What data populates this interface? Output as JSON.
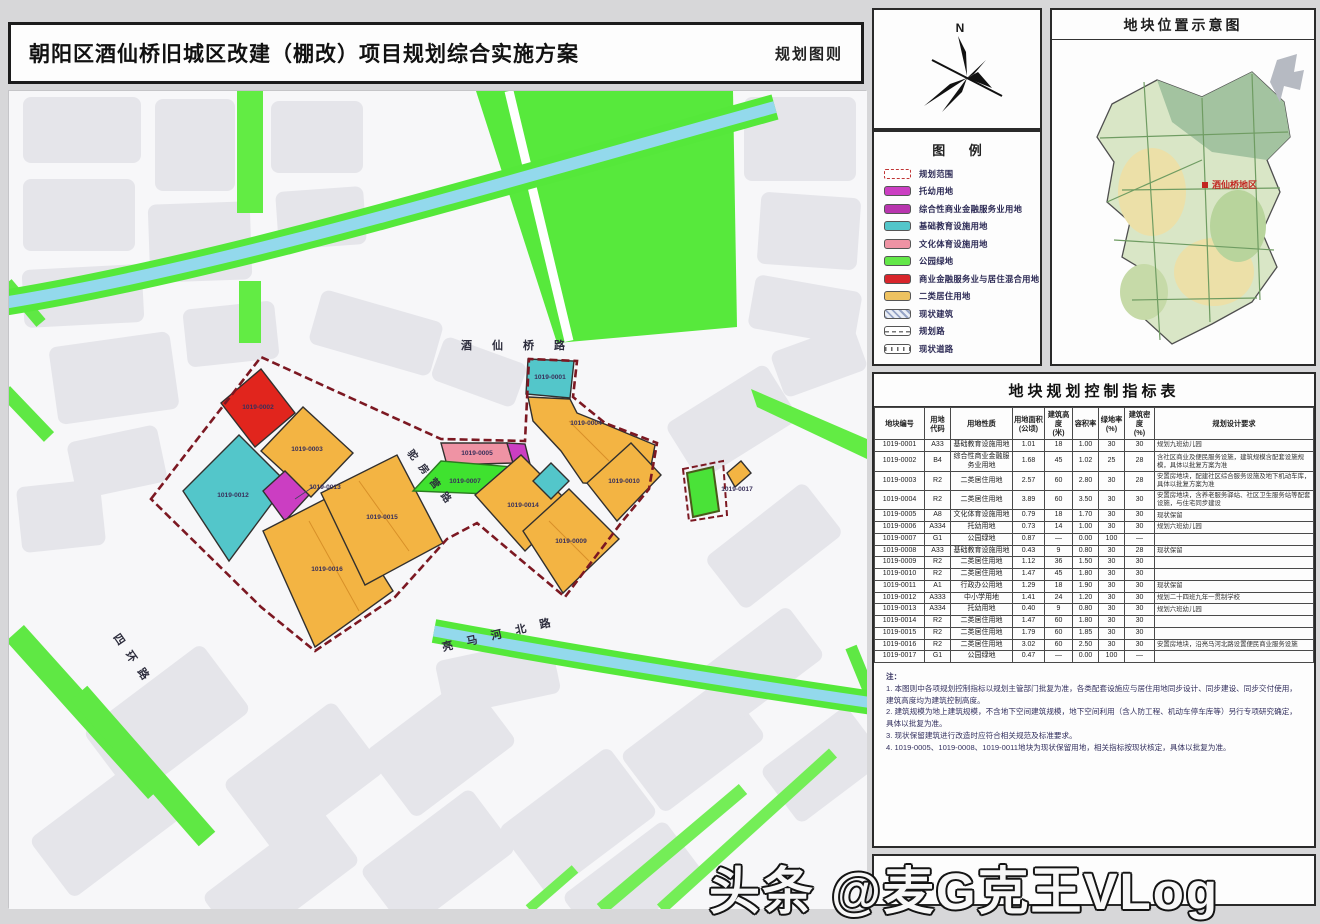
{
  "sheet": {
    "title": "朝阳区酒仙桥旧城区改建（棚改）项目规划综合实施方案",
    "subtitle_right": "规划图则"
  },
  "compass": {
    "label": "N"
  },
  "legend": {
    "title": "图 例",
    "items": [
      {
        "label": "规划范围",
        "swatch": "boundary",
        "color": ""
      },
      {
        "label": "托幼用地",
        "swatch": "fill",
        "color": "#cb3ec2"
      },
      {
        "label": "综合性商业金融服务业用地",
        "swatch": "fill",
        "color": "#b835ae"
      },
      {
        "label": "基础教育设施用地",
        "swatch": "fill",
        "color": "#53c6ca"
      },
      {
        "label": "文化体育设施用地",
        "swatch": "fill",
        "color": "#ef93a4"
      },
      {
        "label": "公园绿地",
        "swatch": "fill",
        "color": "#63e748"
      },
      {
        "label": "商业金融服务业与居住混合用地",
        "swatch": "fill",
        "color": "#d8252b"
      },
      {
        "label": "二类居住用地",
        "swatch": "fill",
        "color": "#eec261"
      },
      {
        "label": "现状建筑",
        "swatch": "hatch",
        "color": ""
      },
      {
        "label": "规划路",
        "swatch": "road-planned",
        "color": ""
      },
      {
        "label": "现状道路",
        "swatch": "road-existing",
        "color": ""
      }
    ]
  },
  "location_map": {
    "title": "地块位置示意图",
    "marker_label": "酒仙桥地区"
  },
  "map": {
    "road_labels": [
      "酒仙桥路",
      "驼房营路",
      "亮马河北路",
      "四环路"
    ],
    "parcel_labels": [
      "1019-0002",
      "1019-0003",
      "1019-0012",
      "1019-0013",
      "1019-0016",
      "1019-0015",
      "1019-0001",
      "1019-0004",
      "1019-0005",
      "1019-0007",
      "1019-0014",
      "1019-0010",
      "1019-0009",
      "1019-0017"
    ]
  },
  "table": {
    "title": "地块规划控制指标表",
    "columns": [
      "地块编号",
      "用地\n代码",
      "用地性质",
      "用地面积\n(公顷)",
      "建筑高度\n(米)",
      "容积率",
      "绿地率\n(%)",
      "建筑密度\n(%)",
      "规划设计要求"
    ],
    "rows": [
      [
        "1019-0001",
        "A33",
        "基础教育设施用地",
        "1.01",
        "18",
        "1.00",
        "30",
        "30",
        "规划九班幼儿园"
      ],
      [
        "1019-0002",
        "B4",
        "综合性商业金融服务业用地",
        "1.68",
        "45",
        "1.02",
        "25",
        "28",
        "含社区商业及便民服务设施，建筑规模含配套设施规模，具体以批复方案为准"
      ],
      [
        "1019-0003",
        "R2",
        "二类居住用地",
        "2.57",
        "60",
        "2.80",
        "30",
        "28",
        "安置房地块，配建社区综合服务设施及地下机动车库，具体以批复方案为准"
      ],
      [
        "1019-0004",
        "R2",
        "二类居住用地",
        "3.89",
        "60",
        "3.50",
        "30",
        "30",
        "安置房地块，含养老服务驿站、社区卫生服务站等配套设施，与住宅同步建设"
      ],
      [
        "1019-0005",
        "A8",
        "文化体育设施用地",
        "0.79",
        "18",
        "1.70",
        "30",
        "30",
        "现状保留"
      ],
      [
        "1019-0006",
        "A334",
        "托幼用地",
        "0.73",
        "14",
        "1.00",
        "30",
        "30",
        "规划六班幼儿园"
      ],
      [
        "1019-0007",
        "G1",
        "公园绿地",
        "0.87",
        "—",
        "0.00",
        "100",
        "—",
        ""
      ],
      [
        "1019-0008",
        "A33",
        "基础教育设施用地",
        "0.43",
        "9",
        "0.80",
        "30",
        "28",
        "现状保留"
      ],
      [
        "1019-0009",
        "R2",
        "二类居住用地",
        "1.12",
        "36",
        "1.50",
        "30",
        "30",
        ""
      ],
      [
        "1019-0010",
        "R2",
        "二类居住用地",
        "1.47",
        "45",
        "1.80",
        "30",
        "30",
        ""
      ],
      [
        "1019-0011",
        "A1",
        "行政办公用地",
        "1.29",
        "18",
        "1.90",
        "30",
        "30",
        "现状保留"
      ],
      [
        "1019-0012",
        "A333",
        "中小学用地",
        "1.41",
        "24",
        "1.20",
        "30",
        "30",
        "规划二十四班九年一贯制学校"
      ],
      [
        "1019-0013",
        "A334",
        "托幼用地",
        "0.40",
        "9",
        "0.80",
        "30",
        "30",
        "规划六班幼儿园"
      ],
      [
        "1019-0014",
        "R2",
        "二类居住用地",
        "1.47",
        "60",
        "1.80",
        "30",
        "30",
        ""
      ],
      [
        "1019-0015",
        "R2",
        "二类居住用地",
        "1.79",
        "60",
        "1.85",
        "30",
        "30",
        ""
      ],
      [
        "1019-0016",
        "R2",
        "二类居住用地",
        "3.02",
        "60",
        "2.50",
        "30",
        "30",
        "安置房地块，沿亮马河北路设置便民商业服务设施"
      ],
      [
        "1019-0017",
        "G1",
        "公园绿地",
        "0.47",
        "—",
        "0.00",
        "100",
        "—",
        ""
      ]
    ]
  },
  "notes": {
    "heading": "注：",
    "items": [
      "1. 本图则中各项规划控制指标以规划主管部门批复为准，各类配套设施应与居住用地同步设计、同步建设、同步交付使用，建筑高度均为建筑控制高度。",
      "2. 建筑规模为地上建筑规模，不含地下空间建筑规模，地下空间利用（含人防工程、机动车停车库等）另行专项研究确定，具体以批复为准。",
      "3. 现状保留建筑进行改造时应符合相关规范及标准要求。",
      "4. 1019-0005、1019-0008、1019-0011地块为现状保留用地，相关指标按现状核定，具体以批复为准。"
    ]
  },
  "watermark": "头条 @麦G克王VLog"
}
